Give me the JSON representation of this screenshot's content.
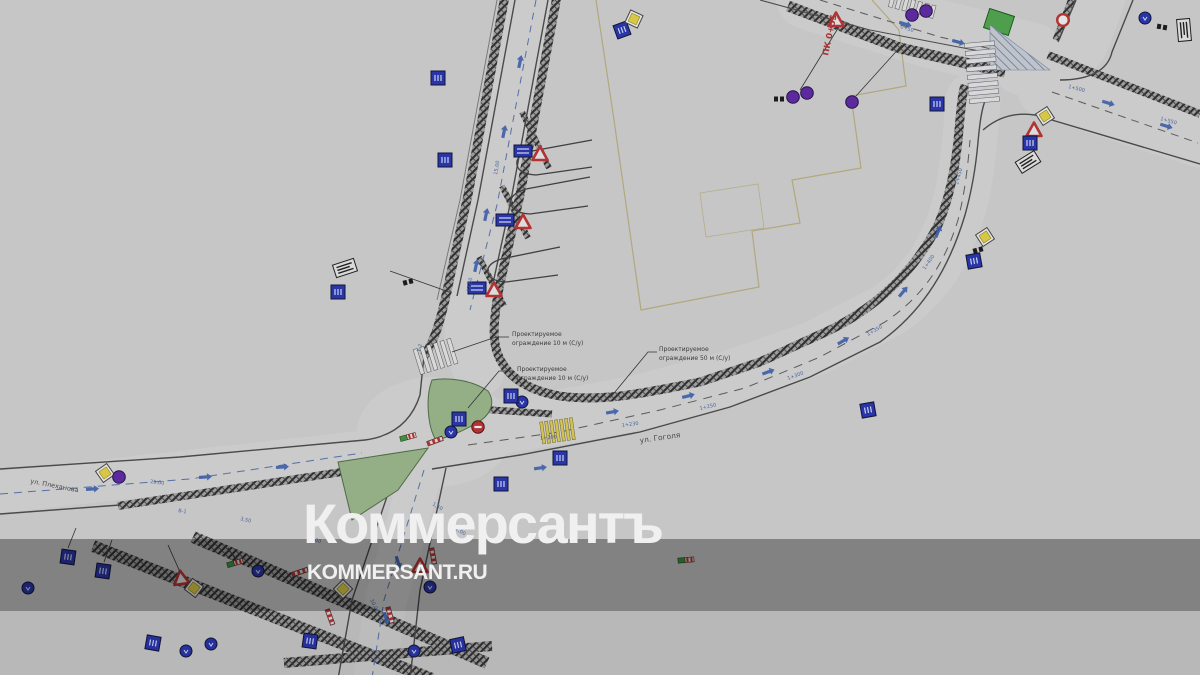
{
  "watermark": {
    "title": "Коммерсантъ",
    "site": "KOMMERSANT.RU"
  },
  "colors": {
    "canvas": "#c6c6c6",
    "band_overlay": "rgba(0,0,0,0.34)",
    "watermark_text": "#f0f0f0",
    "green_island": "#94ae86",
    "green_area": "#4e9e4e",
    "sign_blue": "#2a35a8",
    "sign_purple": "#5b2a9d",
    "sign_red": "#b23333",
    "sign_yellow": "#d6c844",
    "dim_text": "#46649e",
    "station_text": "#a33736",
    "building_outline": "#b1a87e"
  },
  "plan": {
    "streets": [
      {
        "label": "ул. Гоголя"
      },
      {
        "label": "ул. Плеханова"
      }
    ],
    "station": "ПК 0+55",
    "annotations": [
      {
        "line1": "Проектируемое",
        "line2": "ограждение 10 м (С/у)"
      },
      {
        "line1": "Проектируемое",
        "line2": "ограждение 10 м (С/у)"
      },
      {
        "line1": "Проектируемое",
        "line2": "ограждение 50 м (С/у)"
      }
    ],
    "dims": [
      {
        "t": "1+230",
        "x": 622,
        "y": 427,
        "r": -8
      },
      {
        "t": "1+200",
        "x": 540,
        "y": 440,
        "r": -6
      },
      {
        "t": "1+250",
        "x": 700,
        "y": 410,
        "r": -13
      },
      {
        "t": "1+300",
        "x": 788,
        "y": 380,
        "r": -20
      },
      {
        "t": "1+350",
        "x": 868,
        "y": 336,
        "r": -30
      },
      {
        "t": "1+400",
        "x": 925,
        "y": 270,
        "r": -55
      },
      {
        "t": "1+450",
        "x": 958,
        "y": 185,
        "r": -75
      },
      {
        "t": "1+500",
        "x": 1068,
        "y": 88,
        "r": 14
      },
      {
        "t": "1+550",
        "x": 1160,
        "y": 120,
        "r": 16
      },
      {
        "t": "0+50",
        "x": 900,
        "y": 28,
        "r": 17
      },
      {
        "t": "15,00",
        "x": 497,
        "y": 175,
        "r": -80
      },
      {
        "t": "12,50",
        "x": 470,
        "y": 292,
        "r": -80
      },
      {
        "t": "25,00",
        "x": 150,
        "y": 483,
        "r": 7
      },
      {
        "t": "3,50",
        "x": 240,
        "y": 520,
        "r": 14
      },
      {
        "t": "6,00",
        "x": 310,
        "y": 540,
        "r": 16
      },
      {
        "t": "10,00",
        "x": 370,
        "y": 600,
        "r": 65
      },
      {
        "t": "В-1",
        "x": 178,
        "y": 512,
        "r": 10
      },
      {
        "t": "У-2",
        "x": 420,
        "y": 352,
        "r": -75
      },
      {
        "t": "1,50",
        "x": 432,
        "y": 505,
        "r": 30
      },
      {
        "t": "2,00",
        "x": 455,
        "y": 530,
        "r": 30
      }
    ],
    "arrows": [
      {
        "x": 520,
        "y": 62,
        "r": -78
      },
      {
        "x": 504,
        "y": 132,
        "r": -78
      },
      {
        "x": 486,
        "y": 215,
        "r": -78
      },
      {
        "x": 476,
        "y": 266,
        "r": -78
      },
      {
        "x": 612,
        "y": 412,
        "r": -10
      },
      {
        "x": 688,
        "y": 396,
        "r": -14
      },
      {
        "x": 768,
        "y": 372,
        "r": -20
      },
      {
        "x": 843,
        "y": 341,
        "r": -30
      },
      {
        "x": 903,
        "y": 292,
        "r": -50
      },
      {
        "x": 938,
        "y": 232,
        "r": -68
      },
      {
        "x": 905,
        "y": 24,
        "r": 17
      },
      {
        "x": 958,
        "y": 42,
        "r": 15
      },
      {
        "x": 1108,
        "y": 103,
        "r": 17
      },
      {
        "x": 1166,
        "y": 126,
        "r": 17
      },
      {
        "x": 92,
        "y": 489,
        "r": -4
      },
      {
        "x": 205,
        "y": 477,
        "r": -4
      },
      {
        "x": 282,
        "y": 467,
        "r": -4
      },
      {
        "x": 398,
        "y": 562,
        "r": 72
      },
      {
        "x": 386,
        "y": 618,
        "r": 72
      },
      {
        "x": 540,
        "y": 468,
        "r": -8
      }
    ],
    "signs": [
      {
        "type": "blue-square",
        "x": 438,
        "y": 78
      },
      {
        "type": "blue-square",
        "x": 445,
        "y": 160
      },
      {
        "type": "blue-rect",
        "x": 523,
        "y": 151
      },
      {
        "type": "red-triangle",
        "x": 540,
        "y": 154
      },
      {
        "type": "blue-rect",
        "x": 505,
        "y": 220
      },
      {
        "type": "red-triangle",
        "x": 523,
        "y": 222
      },
      {
        "type": "blue-rect",
        "x": 477,
        "y": 288
      },
      {
        "type": "red-triangle",
        "x": 494,
        "y": 290
      },
      {
        "type": "table-sign",
        "x": 345,
        "y": 268,
        "r": -18
      },
      {
        "type": "blue-square",
        "x": 338,
        "y": 292
      },
      {
        "type": "black-bars",
        "x": 408,
        "y": 282,
        "r": -15
      },
      {
        "type": "blue-square",
        "x": 459,
        "y": 419
      },
      {
        "type": "no-entry",
        "x": 478,
        "y": 427
      },
      {
        "type": "blue-circle",
        "x": 451,
        "y": 432
      },
      {
        "type": "stripe-pole",
        "x": 435,
        "y": 441,
        "r": -20
      },
      {
        "type": "green-marker",
        "x": 408,
        "y": 437,
        "r": -15
      },
      {
        "type": "blue-circle",
        "x": 522,
        "y": 402
      },
      {
        "type": "blue-square",
        "x": 511,
        "y": 396
      },
      {
        "type": "blue-square",
        "x": 560,
        "y": 458
      },
      {
        "type": "blue-square",
        "x": 501,
        "y": 484
      },
      {
        "type": "blue-square",
        "x": 868,
        "y": 410,
        "r": -10
      },
      {
        "type": "yellow-diamond",
        "x": 985,
        "y": 237,
        "r": 12
      },
      {
        "type": "black-bars",
        "x": 978,
        "y": 250,
        "r": -15
      },
      {
        "type": "blue-square",
        "x": 974,
        "y": 261,
        "r": -10
      },
      {
        "type": "purple-circle",
        "x": 793,
        "y": 97
      },
      {
        "type": "purple-circle",
        "x": 807,
        "y": 93
      },
      {
        "type": "black-bars",
        "x": 779,
        "y": 99
      },
      {
        "type": "purple-circle",
        "x": 852,
        "y": 102
      },
      {
        "type": "red-triangle",
        "x": 836,
        "y": 20
      },
      {
        "type": "purple-circle",
        "x": 912,
        "y": 15
      },
      {
        "type": "purple-circle",
        "x": 926,
        "y": 11
      },
      {
        "type": "blue-square",
        "x": 937,
        "y": 104
      },
      {
        "type": "red-ring",
        "x": 1063,
        "y": 20
      },
      {
        "type": "blue-circle",
        "x": 1145,
        "y": 18
      },
      {
        "type": "table-sign",
        "x": 1184,
        "y": 30,
        "r": 85
      },
      {
        "type": "black-bars",
        "x": 1162,
        "y": 27,
        "r": 10
      },
      {
        "type": "yellow-diamond",
        "x": 1045,
        "y": 116,
        "r": 12
      },
      {
        "type": "red-triangle",
        "x": 1034,
        "y": 130
      },
      {
        "type": "blue-square",
        "x": 1030,
        "y": 143
      },
      {
        "type": "table-sign",
        "x": 1028,
        "y": 162,
        "r": -32
      },
      {
        "type": "yellow-diamond",
        "x": 105,
        "y": 473,
        "r": 10
      },
      {
        "type": "purple-circle",
        "x": 119,
        "y": 477
      },
      {
        "type": "blue-square",
        "x": 68,
        "y": 557,
        "r": 8
      },
      {
        "type": "blue-square",
        "x": 103,
        "y": 571,
        "r": 8
      },
      {
        "type": "blue-circle",
        "x": 28,
        "y": 588
      },
      {
        "type": "red-triangle",
        "x": 181,
        "y": 578,
        "r": -8
      },
      {
        "type": "yellow-diamond",
        "x": 194,
        "y": 588,
        "r": -8
      },
      {
        "type": "green-marker",
        "x": 235,
        "y": 563,
        "r": -16
      },
      {
        "type": "blue-circle",
        "x": 258,
        "y": 571
      },
      {
        "type": "green-marker",
        "x": 686,
        "y": 560,
        "r": -5
      },
      {
        "type": "yellow-diamond",
        "x": 343,
        "y": 589
      },
      {
        "type": "red-triangle",
        "x": 420,
        "y": 566
      },
      {
        "type": "stripe-pole",
        "x": 433,
        "y": 556,
        "r": 80
      },
      {
        "type": "blue-circle",
        "x": 430,
        "y": 587
      },
      {
        "type": "blue-square",
        "x": 458,
        "y": 645,
        "r": -12
      },
      {
        "type": "blue-circle",
        "x": 414,
        "y": 651
      },
      {
        "type": "blue-square",
        "x": 310,
        "y": 641,
        "r": 8
      },
      {
        "type": "blue-square",
        "x": 153,
        "y": 643,
        "r": 10
      },
      {
        "type": "blue-circle",
        "x": 186,
        "y": 651
      },
      {
        "type": "blue-circle",
        "x": 211,
        "y": 644
      },
      {
        "type": "stripe-pole",
        "x": 300,
        "y": 572,
        "r": -18
      },
      {
        "type": "stripe-pole",
        "x": 330,
        "y": 617,
        "r": 70
      },
      {
        "type": "stripe-pole",
        "x": 390,
        "y": 615,
        "r": 75
      },
      {
        "type": "blue-square",
        "x": 622,
        "y": 30,
        "r": -20
      },
      {
        "type": "yellow-diamond",
        "x": 634,
        "y": 19,
        "r": -20
      }
    ]
  }
}
